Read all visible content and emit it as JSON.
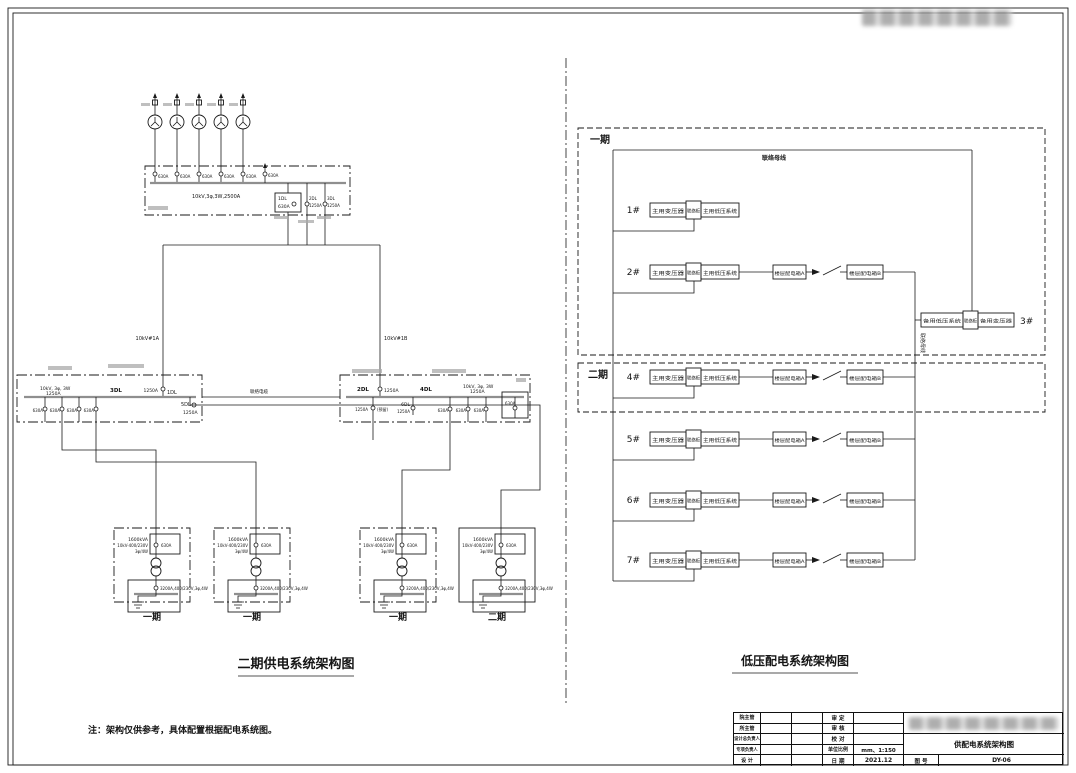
{
  "page": {
    "ink": "#1a1a1a",
    "bus_color": "#8f8f8f",
    "background": "#ffffff"
  },
  "left": {
    "title": "二期供电系统架构图",
    "note": "注：架构仅供参考，具体配置根据配电系统图。",
    "hv": {
      "bus": "10kV,3φ,3W,2500A",
      "breakers": [
        "630A",
        "630A",
        "630A",
        "630A",
        "630A",
        "630A"
      ],
      "box1": {
        "l1": "1DL",
        "l2": "630A"
      },
      "f2": {
        "l1": "2DL",
        "l2": "1250A"
      },
      "f3": {
        "l1": "3DL",
        "l2": "1250A"
      }
    },
    "incomer_a": {
      "name": "10kV#1A",
      "rating": "1250A"
    },
    "incomer_b": {
      "name": "10kV#1B",
      "rating": "1250A"
    },
    "tie": "联络电缆",
    "sec_a": {
      "bus": "10kV, 3φ, 3W",
      "rating": "1250A",
      "d1": "3DL",
      "d2": "1DL",
      "d3": "5DL",
      "d3r": "1250A",
      "out": [
        "630A",
        "630A",
        "630A",
        "630A"
      ]
    },
    "sec_b": {
      "bus": "10kV, 3φ, 3W",
      "rating": "1250A",
      "d1": "2DL",
      "d1r": "1250A",
      "res": "(预留)",
      "d2": "4DL",
      "d3": "6DL",
      "d3r": "1250A",
      "out": [
        "630A",
        "630A",
        "630A"
      ],
      "end": "630A"
    },
    "tx": [
      {
        "kva": "1600kVA",
        "ratio": "10kV-400/230V",
        "conn": "3φ/4W",
        "brk": "630A",
        "lv": "3200A,400/230V,3φ,4W",
        "phase": "一期"
      },
      {
        "kva": "1600kVA",
        "ratio": "10kV-400/230V",
        "conn": "3φ/4W",
        "brk": "630A",
        "lv": "3200A,400/230V,3φ,4W",
        "phase": "一期"
      },
      {
        "kva": "1600kVA",
        "ratio": "10kV-400/230V",
        "conn": "3φ/4W",
        "brk": "630A",
        "lv": "3200A,400/230V,3φ,4W",
        "phase": "一期"
      },
      {
        "kva": "1600kVA",
        "ratio": "10kV-400/230V",
        "conn": "3φ/4W",
        "brk": "630A",
        "lv": "3200A,400/230V,3φ,4W",
        "phase": "二期"
      }
    ]
  },
  "right": {
    "title": "低压配电系统架构图",
    "phase1": "一期",
    "phase2": "二期",
    "top_bus": "联络母线",
    "tie_bus": "联络母线",
    "rows": [
      {
        "id": "1#",
        "t1": "主用变压器",
        "t2": "联络柜",
        "t3": "主用低压系统",
        "a": "",
        "b": ""
      },
      {
        "id": "2#",
        "t1": "主用变压器",
        "t2": "联络柜",
        "t3": "主用低压系统",
        "a": "楼层配电箱A",
        "b": "楼层配电箱B"
      },
      {
        "id": "4#",
        "t1": "主用变压器",
        "t2": "联络柜",
        "t3": "主用低压系统",
        "a": "楼层配电箱A",
        "b": "楼层配电箱B"
      },
      {
        "id": "5#",
        "t1": "主用变压器",
        "t2": "联络柜",
        "t3": "主用低压系统",
        "a": "楼层配电箱A",
        "b": "楼层配电箱B"
      },
      {
        "id": "6#",
        "t1": "主用变压器",
        "t2": "联络柜",
        "t3": "主用低压系统",
        "a": "楼层配电箱A",
        "b": "楼层配电箱B"
      },
      {
        "id": "7#",
        "t1": "主用变压器",
        "t2": "联络柜",
        "t3": "主用低压系统",
        "a": "楼层配电箱A",
        "b": "楼层配电箱B"
      }
    ],
    "backup": {
      "id": "3#",
      "t1": "备用低压系统",
      "t2": "联络柜",
      "t3": "备用变压器"
    }
  },
  "titleblock": {
    "c1": [
      "院主管",
      "所主管",
      "设计总负责人",
      "专项负责人",
      "设 计"
    ],
    "c4": [
      "审 定",
      "审 核",
      "校 对",
      "单位比例",
      "日 期"
    ],
    "scale": "mm、1:150",
    "date": "2021.12",
    "dwg_title": "供配电系统架构图",
    "no_label": "图 号",
    "no": "DY-06"
  }
}
